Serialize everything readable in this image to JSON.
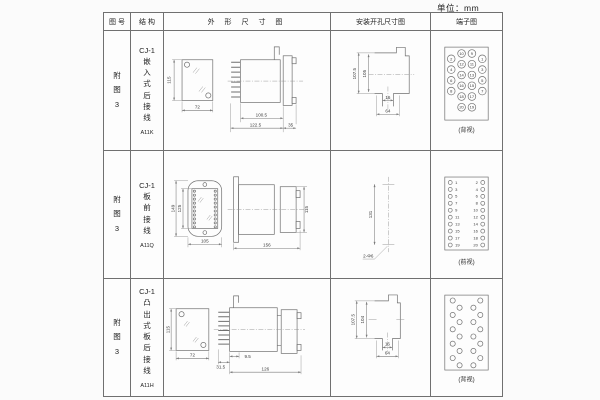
{
  "page": {
    "unit_label": "单位：mm"
  },
  "colors": {
    "line": "#6f6f6f",
    "table_border": "#707070",
    "text": "#333333",
    "background": "#fbfbfb"
  },
  "table": {
    "headers": [
      "图 号",
      "结 构",
      "外 形 尺 寸 图",
      "安装开孔尺寸图",
      "端子图"
    ],
    "rows": [
      {
        "fig_label": "附\n图\n3",
        "structure_label": "CJ-1\n嵌\n入\n式\n后\n接\n线",
        "model": "A11K",
        "outline": {
          "height": "115",
          "width": "72",
          "depth_body": "100.5",
          "depth_total": "122.5",
          "flange_depth": "35"
        },
        "install": {
          "v_outer": "107.5",
          "v_inner": "105",
          "h_inner": "16",
          "h_outer": "64"
        },
        "terminal": {
          "view_label": "(背视)",
          "columns": [
            {
              "name": "outer-left",
              "values": [
                "2",
                "4",
                "6",
                "8"
              ]
            },
            {
              "name": "inner-left",
              "values": [
                "10",
                "12",
                "14",
                "16",
                "18",
                "20"
              ]
            },
            {
              "name": "inner-right",
              "values": [
                "9",
                "11",
                "13",
                "15",
                "17",
                "19"
              ]
            },
            {
              "name": "outer-right",
              "values": [
                "1",
                "3",
                "5",
                "7"
              ]
            }
          ]
        }
      },
      {
        "fig_label": "附\n图\n3",
        "structure_label": "CJ-1\n板\n前\n接\n线",
        "model": "A11Q",
        "outline": {
          "height_outer": "149",
          "height_inner": "125",
          "width": "105",
          "depth": "156",
          "height_side": "115"
        },
        "install": {
          "spacing": "131",
          "holes": "2-Φ6"
        },
        "terminal": {
          "view_label": "(前视)",
          "columns": [
            {
              "name": "left",
              "values": [
                "1",
                "3",
                "5",
                "7",
                "9",
                "11",
                "13",
                "15",
                "17",
                "19"
              ]
            },
            {
              "name": "right",
              "values": [
                "2",
                "4",
                "6",
                "8",
                "10",
                "12",
                "14",
                "16",
                "18",
                "20"
              ]
            }
          ]
        }
      },
      {
        "fig_label": "附\n图\n3",
        "structure_label": "CJ-1\n凸\n出\n式\n板\n后\n接\n线",
        "model": "A11H",
        "outline": {
          "height": "115",
          "width": "72",
          "pin_depth": "9.5",
          "front_depth": "31.5",
          "depth": "126"
        },
        "install": {
          "v_outer": "107.5",
          "v_inner": "104",
          "h_inner": "16",
          "h_outer": "64"
        },
        "terminal": {
          "view_label": "(背视)",
          "pins": 20
        }
      }
    ]
  }
}
